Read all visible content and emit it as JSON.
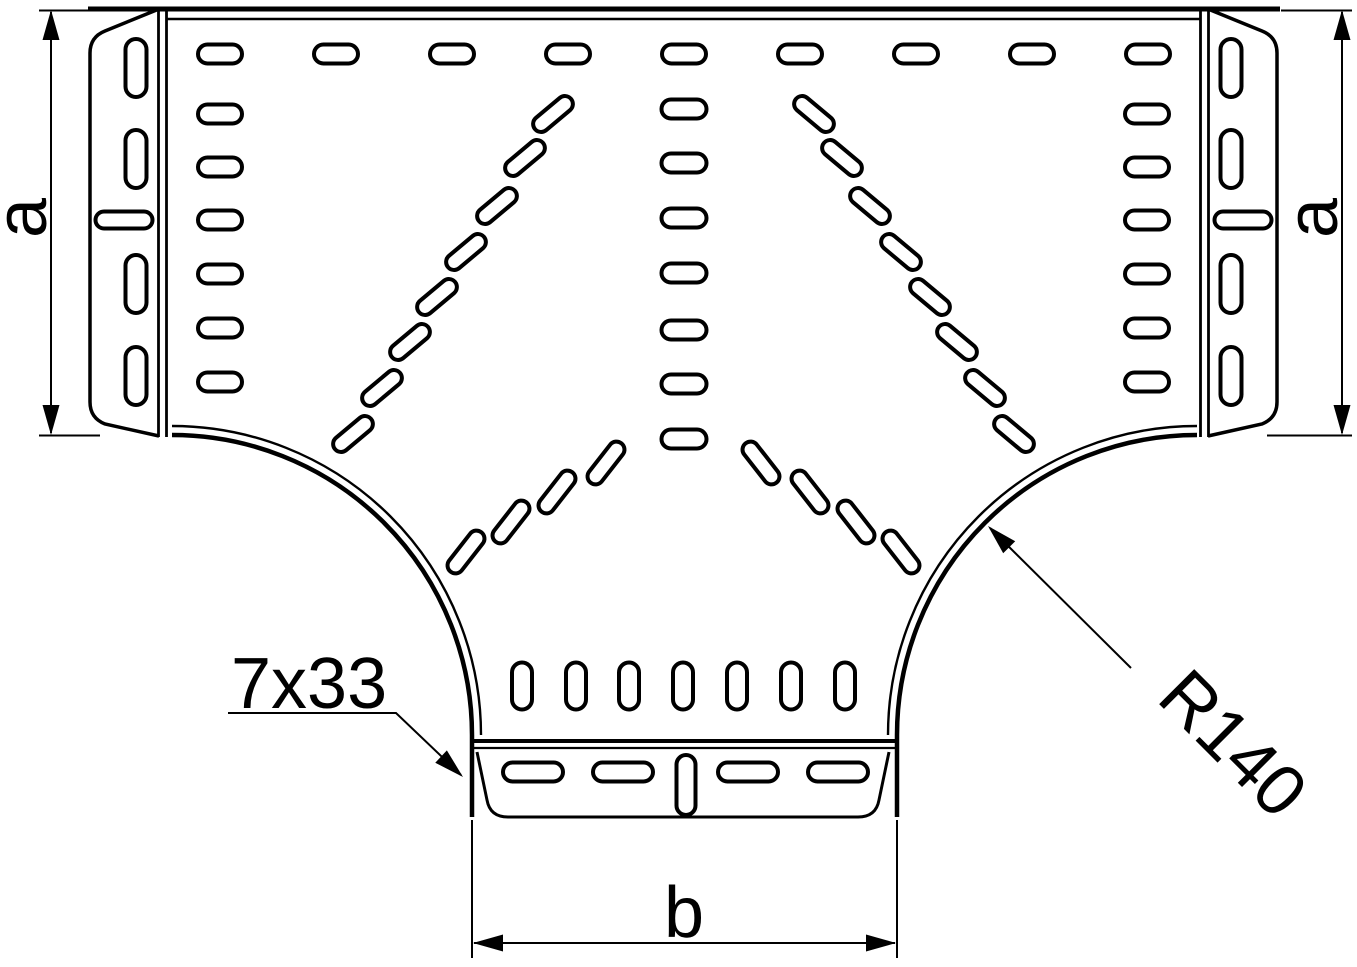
{
  "figure": {
    "type": "technical-drawing",
    "subject": "perforated-cable-tray-tee-piece-plan-view",
    "background": "#ffffff",
    "line_color": "#000000",
    "labels": {
      "dim_a_left": "a",
      "dim_a_right": "a",
      "dim_b": "b",
      "slot_note": "7x33",
      "radius_note": "R140"
    },
    "slots": [
      [
        220,
        54,
        44,
        19,
        0
      ],
      [
        336,
        54,
        44,
        19,
        0
      ],
      [
        452,
        54,
        44,
        19,
        0
      ],
      [
        568,
        54,
        44,
        19,
        0
      ],
      [
        684,
        54,
        44,
        19,
        0
      ],
      [
        800,
        54,
        44,
        19,
        0
      ],
      [
        916,
        54,
        44,
        19,
        0
      ],
      [
        1032,
        54,
        44,
        19,
        0
      ],
      [
        1148,
        54,
        44,
        19,
        0
      ],
      [
        220,
        114,
        44,
        19,
        0
      ],
      [
        220,
        167,
        44,
        19,
        0
      ],
      [
        220,
        220,
        44,
        19,
        0
      ],
      [
        220,
        274,
        44,
        19,
        0
      ],
      [
        220,
        328,
        44,
        19,
        0
      ],
      [
        220,
        382,
        44,
        19,
        0
      ],
      [
        1147,
        114,
        44,
        19,
        0
      ],
      [
        1147,
        167,
        44,
        19,
        0
      ],
      [
        1147,
        220,
        44,
        19,
        0
      ],
      [
        1147,
        274,
        44,
        19,
        0
      ],
      [
        1147,
        328,
        44,
        19,
        0
      ],
      [
        1147,
        382,
        44,
        19,
        0
      ],
      [
        684,
        109,
        45,
        19,
        0
      ],
      [
        684,
        163,
        45,
        19,
        0
      ],
      [
        684,
        218,
        45,
        19,
        0
      ],
      [
        684,
        273,
        45,
        19,
        0
      ],
      [
        684,
        330,
        45,
        19,
        0
      ],
      [
        684,
        384,
        45,
        19,
        0
      ],
      [
        684,
        439,
        45,
        19,
        0
      ],
      [
        553,
        114,
        47,
        16,
        -40
      ],
      [
        525,
        158,
        47,
        16,
        -40
      ],
      [
        497,
        206,
        47,
        16,
        -40
      ],
      [
        466,
        252,
        47,
        16,
        -40
      ],
      [
        437,
        297,
        47,
        16,
        -40
      ],
      [
        410,
        342,
        47,
        16,
        -40
      ],
      [
        382,
        388,
        47,
        16,
        -40
      ],
      [
        353,
        434,
        47,
        16,
        -40
      ],
      [
        814,
        114,
        47,
        16,
        40
      ],
      [
        842,
        158,
        47,
        16,
        40
      ],
      [
        870,
        206,
        47,
        16,
        40
      ],
      [
        901,
        252,
        47,
        16,
        40
      ],
      [
        930,
        297,
        47,
        16,
        40
      ],
      [
        957,
        342,
        47,
        16,
        40
      ],
      [
        985,
        388,
        47,
        16,
        40
      ],
      [
        1014,
        434,
        47,
        16,
        40
      ],
      [
        606,
        463,
        50,
        16,
        -52
      ],
      [
        557,
        492,
        50,
        16,
        -52
      ],
      [
        511,
        522,
        50,
        16,
        -52
      ],
      [
        466,
        552,
        50,
        16,
        -52
      ],
      [
        761,
        463,
        50,
        16,
        52
      ],
      [
        810,
        492,
        50,
        16,
        52
      ],
      [
        856,
        522,
        50,
        16,
        52
      ],
      [
        901,
        552,
        50,
        16,
        52
      ],
      [
        522,
        686,
        47,
        20,
        90
      ],
      [
        576,
        686,
        47,
        20,
        90
      ],
      [
        629,
        686,
        47,
        20,
        90
      ],
      [
        683,
        686,
        47,
        20,
        90
      ],
      [
        737,
        686,
        47,
        20,
        90
      ],
      [
        791,
        686,
        47,
        20,
        90
      ],
      [
        845,
        686,
        47,
        20,
        90
      ],
      [
        533,
        772,
        60,
        19,
        0
      ],
      [
        623,
        772,
        60,
        19,
        0
      ],
      [
        748,
        772,
        60,
        19,
        0
      ],
      [
        838,
        772,
        60,
        19,
        0
      ],
      [
        686,
        785,
        60,
        19,
        90
      ],
      [
        136,
        68,
        58,
        21,
        90
      ],
      [
        136,
        159,
        58,
        21,
        90
      ],
      [
        136,
        284,
        58,
        21,
        90
      ],
      [
        136,
        376,
        58,
        21,
        90
      ],
      [
        124,
        220,
        57,
        17,
        0
      ],
      [
        1231,
        68,
        58,
        21,
        90
      ],
      [
        1231,
        159,
        58,
        21,
        90
      ],
      [
        1231,
        284,
        58,
        21,
        90
      ],
      [
        1231,
        376,
        58,
        21,
        90
      ],
      [
        1243,
        220,
        57,
        17,
        0
      ]
    ]
  }
}
